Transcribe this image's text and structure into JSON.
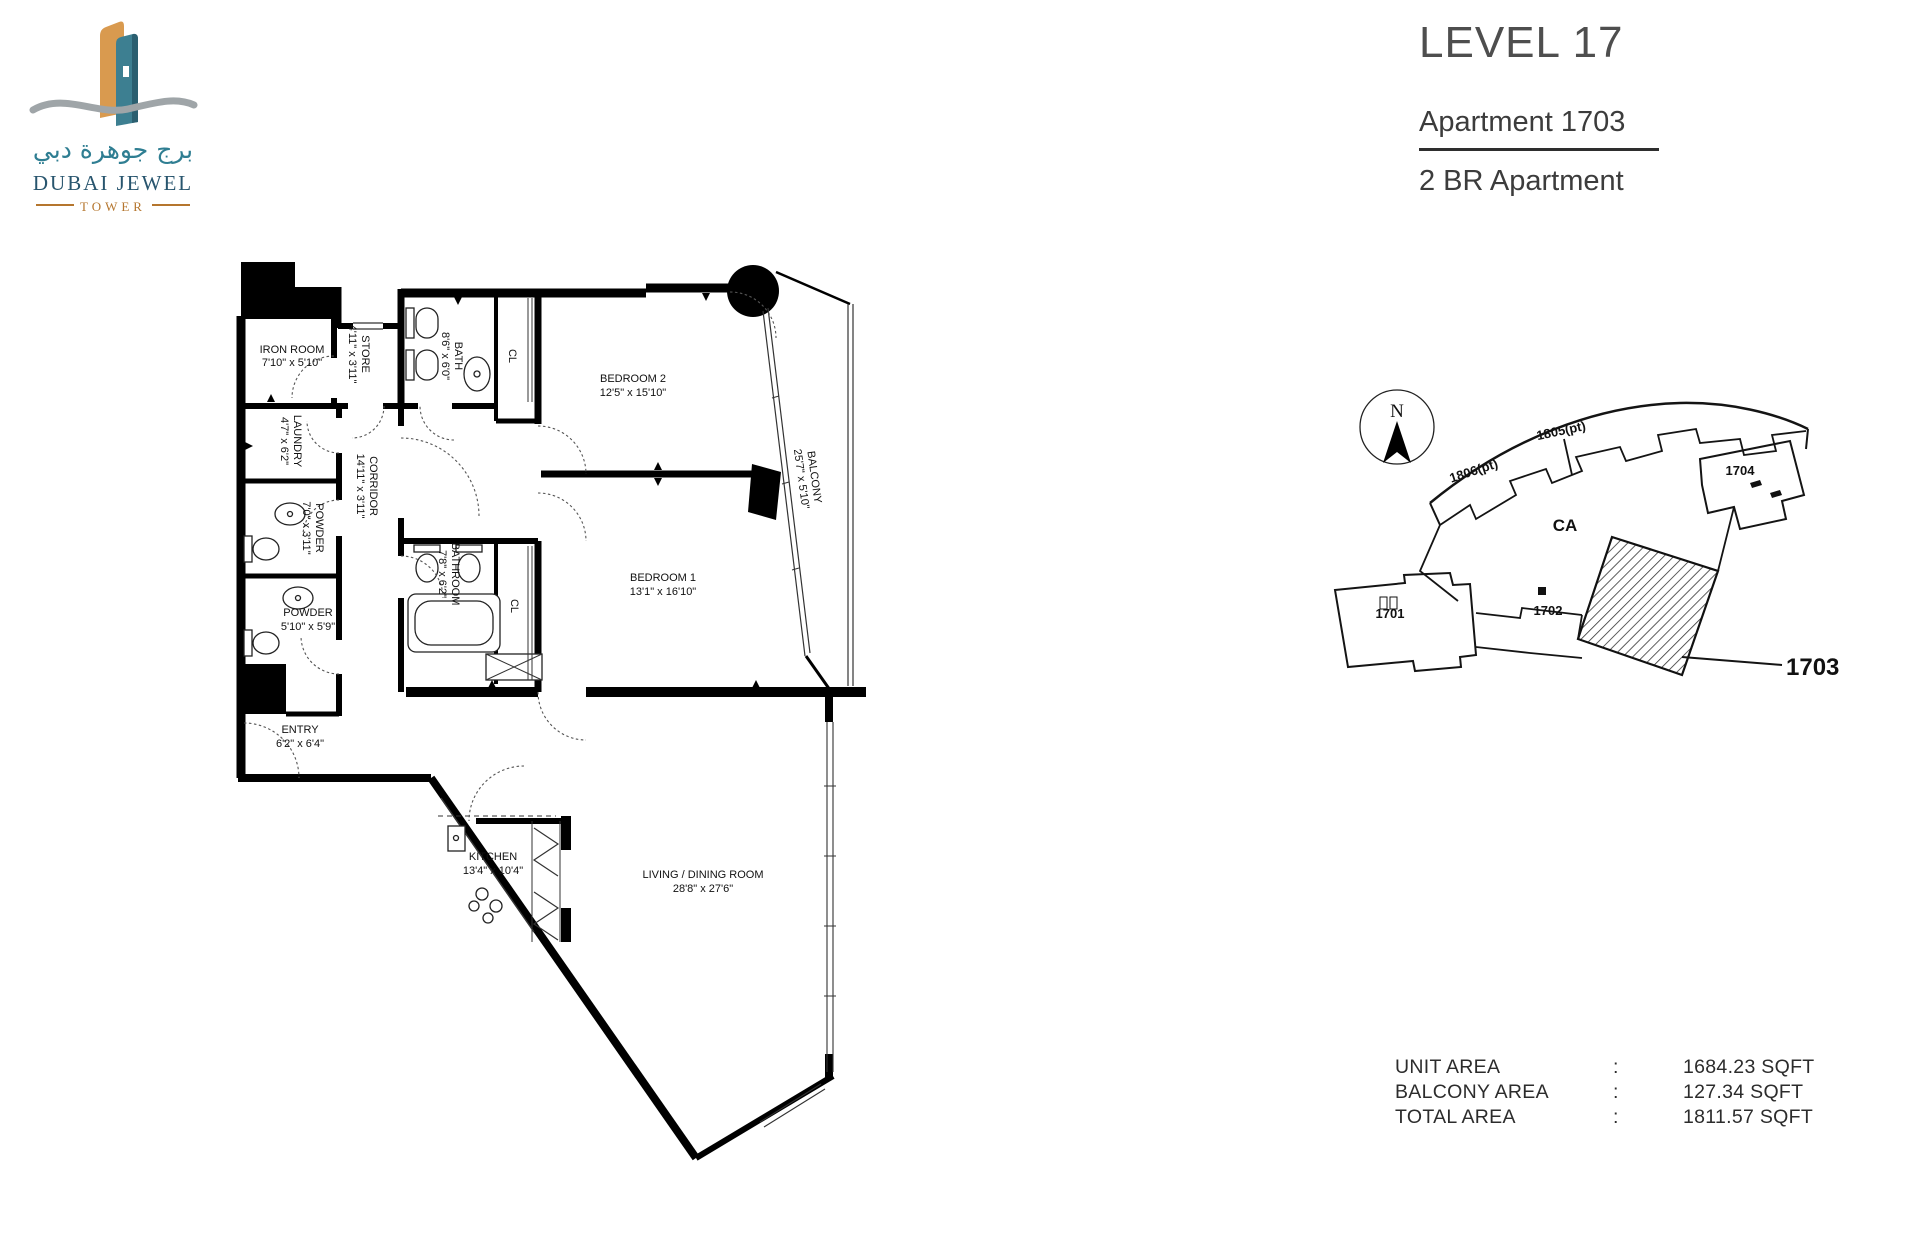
{
  "logo": {
    "arabic": "برج جوهرة دبي",
    "title": "DUBAI JEWEL",
    "subtitle": "TOWER"
  },
  "header": {
    "level": "LEVEL 17",
    "apartment": "Apartment 1703",
    "unit_type": "2 BR Apartment"
  },
  "floorplan": {
    "rooms": {
      "iron": {
        "name": "IRON ROOM",
        "dims": "7'10\" x 5'10\""
      },
      "store": {
        "name": "STORE",
        "dims": "4'11\" x 3'11\""
      },
      "bath": {
        "name": "BATH",
        "dims": "8'6\" x 6'0\""
      },
      "cl_a": {
        "name": "CL"
      },
      "bedroom2": {
        "name": "BEDROOM 2",
        "dims": "12'5\" x 15'10\""
      },
      "balcony": {
        "name": "BALCONY",
        "dims": "25'7\" x 5'10\""
      },
      "laundry": {
        "name": "LAUNDRY",
        "dims": "4'7\" x 6'2\""
      },
      "corridor": {
        "name": "CORRIDOR",
        "dims": "14'11\" x 3'11\""
      },
      "powder_upper": {
        "name": "POWDER",
        "dims": "7'0\" x 3'11\""
      },
      "bathroom": {
        "name": "BATHROOM",
        "dims": "7'8\" x 6'2\""
      },
      "cl_b": {
        "name": "CL"
      },
      "bedroom1": {
        "name": "BEDROOM 1",
        "dims": "13'1\" x 16'10\""
      },
      "powder_lower": {
        "name": "POWDER",
        "dims": "5'10\" x 5'9\""
      },
      "entry": {
        "name": "ENTRY",
        "dims": "6'2\" x 6'4\""
      },
      "kitchen": {
        "name": "KITCHEN",
        "dims": "13'4\" x 10'4\""
      },
      "living": {
        "name": "LIVING / DINING ROOM",
        "dims": "28'8\" x 27'6\""
      }
    }
  },
  "keyplan": {
    "north_label": "N",
    "units": {
      "u1806": "1806(pt)",
      "u1805": "1805(pt)",
      "u1704": "1704",
      "ca": "CA",
      "u1701": "1701",
      "u1702": "1702"
    },
    "highlight_label": "1703"
  },
  "areas": {
    "unit": {
      "label": "UNIT AREA",
      "colon": ":",
      "value": "1684.23 SQFT"
    },
    "balcony": {
      "label": "BALCONY AREA",
      "colon": ":",
      "value": "127.34 SQFT"
    },
    "total": {
      "label": "TOTAL AREA",
      "colon": ":",
      "value": "1811.57 SQFT"
    }
  },
  "colors": {
    "logo_teal": "#2f7e92",
    "logo_navy": "#28556e",
    "logo_orange": "#b5762e",
    "title_gray": "#4e4e4e",
    "line_black": "#000000"
  }
}
